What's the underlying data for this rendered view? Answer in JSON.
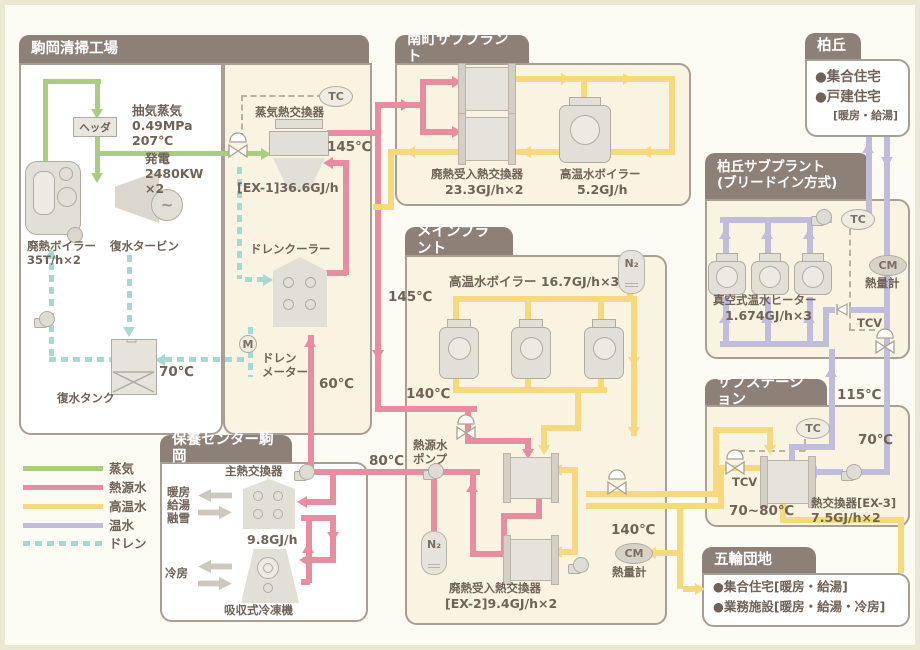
{
  "colors": {
    "steam": "#a9cf7e",
    "heat_source": "#e88da0",
    "high_temp": "#f6d87e",
    "warm": "#c1bbdc",
    "drain": "#a6d8d4",
    "tab": "#8d8077",
    "panel_beige": "#f8f4e1",
    "text": "#6f6257"
  },
  "legend": {
    "items": [
      {
        "label": "蒸気",
        "color": "#a9cf7e",
        "style": "solid"
      },
      {
        "label": "熱源水",
        "color": "#e88da0",
        "style": "solid"
      },
      {
        "label": "高温水",
        "color": "#f6d87e",
        "style": "solid"
      },
      {
        "label": "温水",
        "color": "#c1bbdc",
        "style": "solid"
      },
      {
        "label": "ドレン",
        "color": "#a6d8d4",
        "style": "dashed"
      }
    ]
  },
  "komaoka": {
    "title": "駒岡清掃工場",
    "header_label": "ヘッダ",
    "extraction_l1": "抽気蒸気",
    "extraction_l2": "0.49MPa",
    "extraction_l3": "207℃",
    "power_l1": "発電",
    "power_l2": "2480KW",
    "power_l3": "×2",
    "waste_boiler_l1": "廃熱ボイラー",
    "waste_boiler_l2": "35T/h×2",
    "turbine": "復水タービン",
    "tank": "復水タンク",
    "temp70": "70℃",
    "tc": "TC",
    "steam_hx": "蒸気熱交換器",
    "temp145": "145℃",
    "ex1": "[EX-1]36.6GJ/h",
    "drain_cooler": "ドレンクーラー",
    "m": "M",
    "meter_l1": "ドレン",
    "meter_l2": "メーター",
    "temp60": "60℃"
  },
  "routes": {
    "temp145": "145℃",
    "temp140": "140℃",
    "temp80": "80℃"
  },
  "minamimachi": {
    "title": "南町サブプラント",
    "hx_l1": "廃熱受入熱交換器",
    "hx_l2": "23.3GJ/h×2",
    "boiler_l1": "高温水ボイラー",
    "boiler_l2": "5.2GJ/h"
  },
  "main_plant": {
    "title": "メインプラント",
    "boilers": "高温水ボイラー 16.7GJ/h×3",
    "n2": "N₂",
    "pump_l1": "熱源水",
    "pump_l2": "ポンプ",
    "ex2_l1": "廃熱受入熱交換器",
    "ex2_l2": "[EX-2]9.4GJ/h×2",
    "temp140": "140℃",
    "cm": "CM",
    "meter": "熱量計"
  },
  "kashiwaoka": {
    "title": "柏丘",
    "line1": "●集合住宅",
    "line2": "●戸建住宅",
    "line3": "[暖房・給湯]"
  },
  "kashiwaoka_sub": {
    "title_l1": "柏丘サブプラント",
    "title_l2": "(ブリードイン方式)",
    "tc": "TC",
    "cm": "CM",
    "meter": "熱量計",
    "tcv": "TCV",
    "heater_l1": "真空式温水ヒーター",
    "heater_l2": "1.674GJ/h×3"
  },
  "substation": {
    "title": "サブステーション",
    "tc": "TC",
    "tcv": "TCV",
    "range": "70~80℃",
    "hx_l1": "熱交換器[EX-3]",
    "hx_l2": "7.5GJ/h×2",
    "temp115": "115℃",
    "temp70": "70℃"
  },
  "gorin": {
    "title": "五輪団地",
    "line1": "●集合住宅[暖房・給湯]",
    "line2": "●業務施設[暖房・給湯・冷房]"
  },
  "hoyo": {
    "title": "保養センター駒岡",
    "hx": "主熱交換器",
    "capacity": "9.8GJ/h",
    "load1": "暖房",
    "load2": "給湯",
    "load3": "融雪",
    "cool": "冷房",
    "chiller": "吸収式冷凍機",
    "temp80": "80℃"
  }
}
